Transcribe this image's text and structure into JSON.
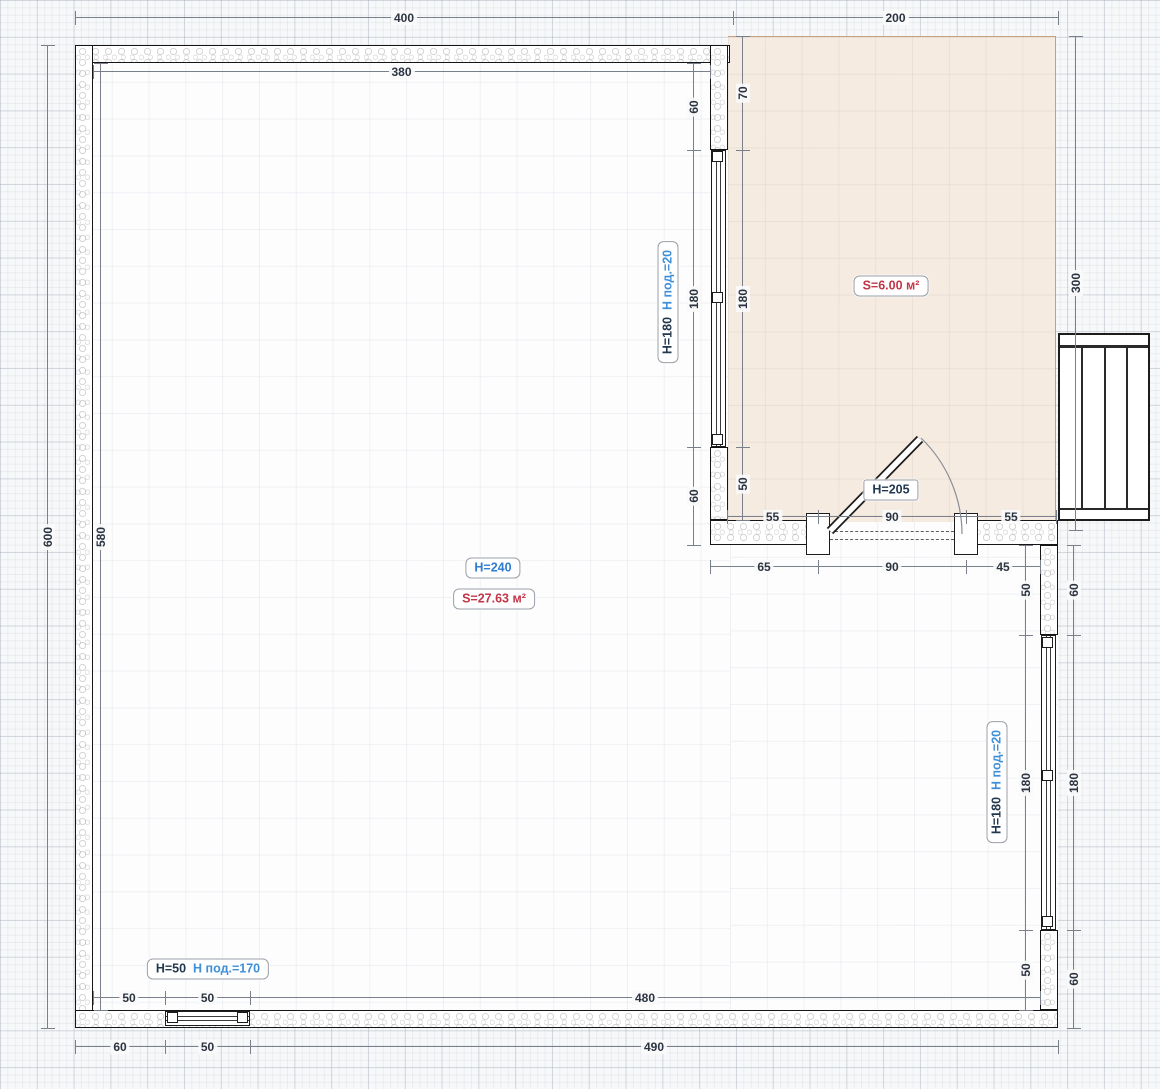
{
  "rooms": {
    "main": {
      "height_label": "H=240",
      "area_label": "S=27.63 м²"
    },
    "hall": {
      "area_label": "S=6.00 м²"
    }
  },
  "door": {
    "label": "H=205"
  },
  "windows": {
    "middle": {
      "h": "H=180",
      "sill": "Н под.=20"
    },
    "right": {
      "h": "H=180",
      "sill": "Н под.=20"
    },
    "bottom": {
      "h": "H=50",
      "sill": "Н под.=170"
    }
  },
  "dims": {
    "top_outer_left": "400",
    "top_outer_right": "200",
    "top_inner": "380",
    "left_outer": "600",
    "left_inner": "580",
    "mid_main_top": "60",
    "mid_main_window": "180",
    "mid_main_bottom": "60",
    "mid_hall_top": "70",
    "mid_hall_window": "180",
    "mid_hall_bottom": "50",
    "hall_right": "300",
    "door_top_left": "55",
    "door_top_mid": "90",
    "door_top_right": "55",
    "door_bottom_left": "65",
    "door_bottom_mid": "90",
    "door_bottom_right": "45",
    "right_inner_top": "50",
    "right_inner_window": "180",
    "right_inner_bottom": "50",
    "right_outer_top": "60",
    "right_outer_window": "180",
    "right_outer_bottom": "60",
    "bottom_inner_left": "50",
    "bottom_inner_window": "50",
    "bottom_inner_right": "480",
    "bottom_outer_left": "60",
    "bottom_outer_window": "50",
    "bottom_outer_right": "490"
  },
  "colors": {
    "accent_blue": "#2f7cd0",
    "accent_red": "#c23648",
    "sill_blue": "#3f8fd8",
    "dim_text": "#2b3440",
    "hall_fill": "#f5ebe1",
    "wall_line": "#161616"
  }
}
